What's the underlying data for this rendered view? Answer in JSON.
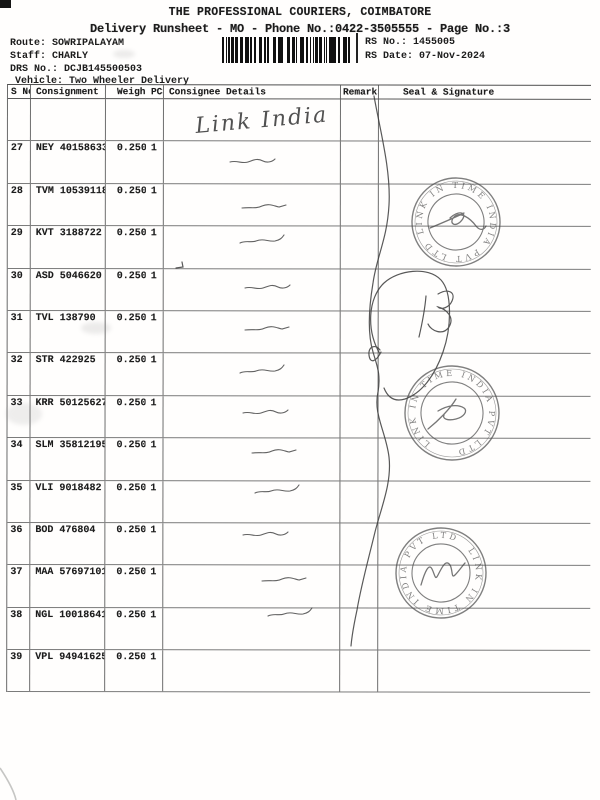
{
  "page": {
    "title": "THE PROFESSIONAL COURIERS, COIMBATORE",
    "subtitle": "Delivery Runsheet - MO - Phone No.:0422-3505555 - Page No.:3"
  },
  "meta": {
    "route_label": "Route:",
    "route": "SOWRIPALAYAM",
    "staff_label": "Staff:",
    "staff": "CHARLY",
    "drs_label": "DRS No.:",
    "drs": "DCJB145500503",
    "vehicle_label": "Vehicle:",
    "vehicle": "Two Wheeler Delivery",
    "rs_no_label": "RS No.:",
    "rs_no": "1455005",
    "rs_date_label": "RS Date:",
    "rs_date": "07-Nov-2024"
  },
  "table": {
    "headers": [
      "S No",
      "Consignment No",
      "Weight",
      "PCS",
      "Consignee Details",
      "Remarks",
      "Seal & Signature"
    ],
    "rows": [
      {
        "s_no": "27",
        "consignment": "NEY 40158633",
        "weight": "0.250",
        "pcs": "1"
      },
      {
        "s_no": "28",
        "consignment": "TVM 10539118",
        "weight": "0.250",
        "pcs": "1"
      },
      {
        "s_no": "29",
        "consignment": "KVT 3188722",
        "weight": "0.250",
        "pcs": "1"
      },
      {
        "s_no": "30",
        "consignment": "ASD 5046620",
        "weight": "0.250",
        "pcs": "1"
      },
      {
        "s_no": "31",
        "consignment": "TVL 138790",
        "weight": "0.250",
        "pcs": "1"
      },
      {
        "s_no": "32",
        "consignment": "STR 422925",
        "weight": "0.250",
        "pcs": "1"
      },
      {
        "s_no": "33",
        "consignment": "KRR 50125627",
        "weight": "0.250",
        "pcs": "1"
      },
      {
        "s_no": "34",
        "consignment": "SLM 358121955",
        "weight": "0.250",
        "pcs": "1"
      },
      {
        "s_no": "35",
        "consignment": "VLI 9018482",
        "weight": "0.250",
        "pcs": "1"
      },
      {
        "s_no": "36",
        "consignment": "BOD 476804",
        "weight": "0.250",
        "pcs": "1"
      },
      {
        "s_no": "37",
        "consignment": "MAA 576971019",
        "weight": "0.250",
        "pcs": "1"
      },
      {
        "s_no": "38",
        "consignment": "NGL 100186410",
        "weight": "0.250",
        "pcs": "1"
      },
      {
        "s_no": "39",
        "consignment": "VPL 949416253",
        "weight": "0.250",
        "pcs": "1"
      }
    ]
  },
  "handwriting": {
    "consignee_note": "Link India"
  },
  "stamps": {
    "ring_text": "LINK IN TIME INDIA PVT LTD",
    "ink_color": "#4a4a4a"
  }
}
